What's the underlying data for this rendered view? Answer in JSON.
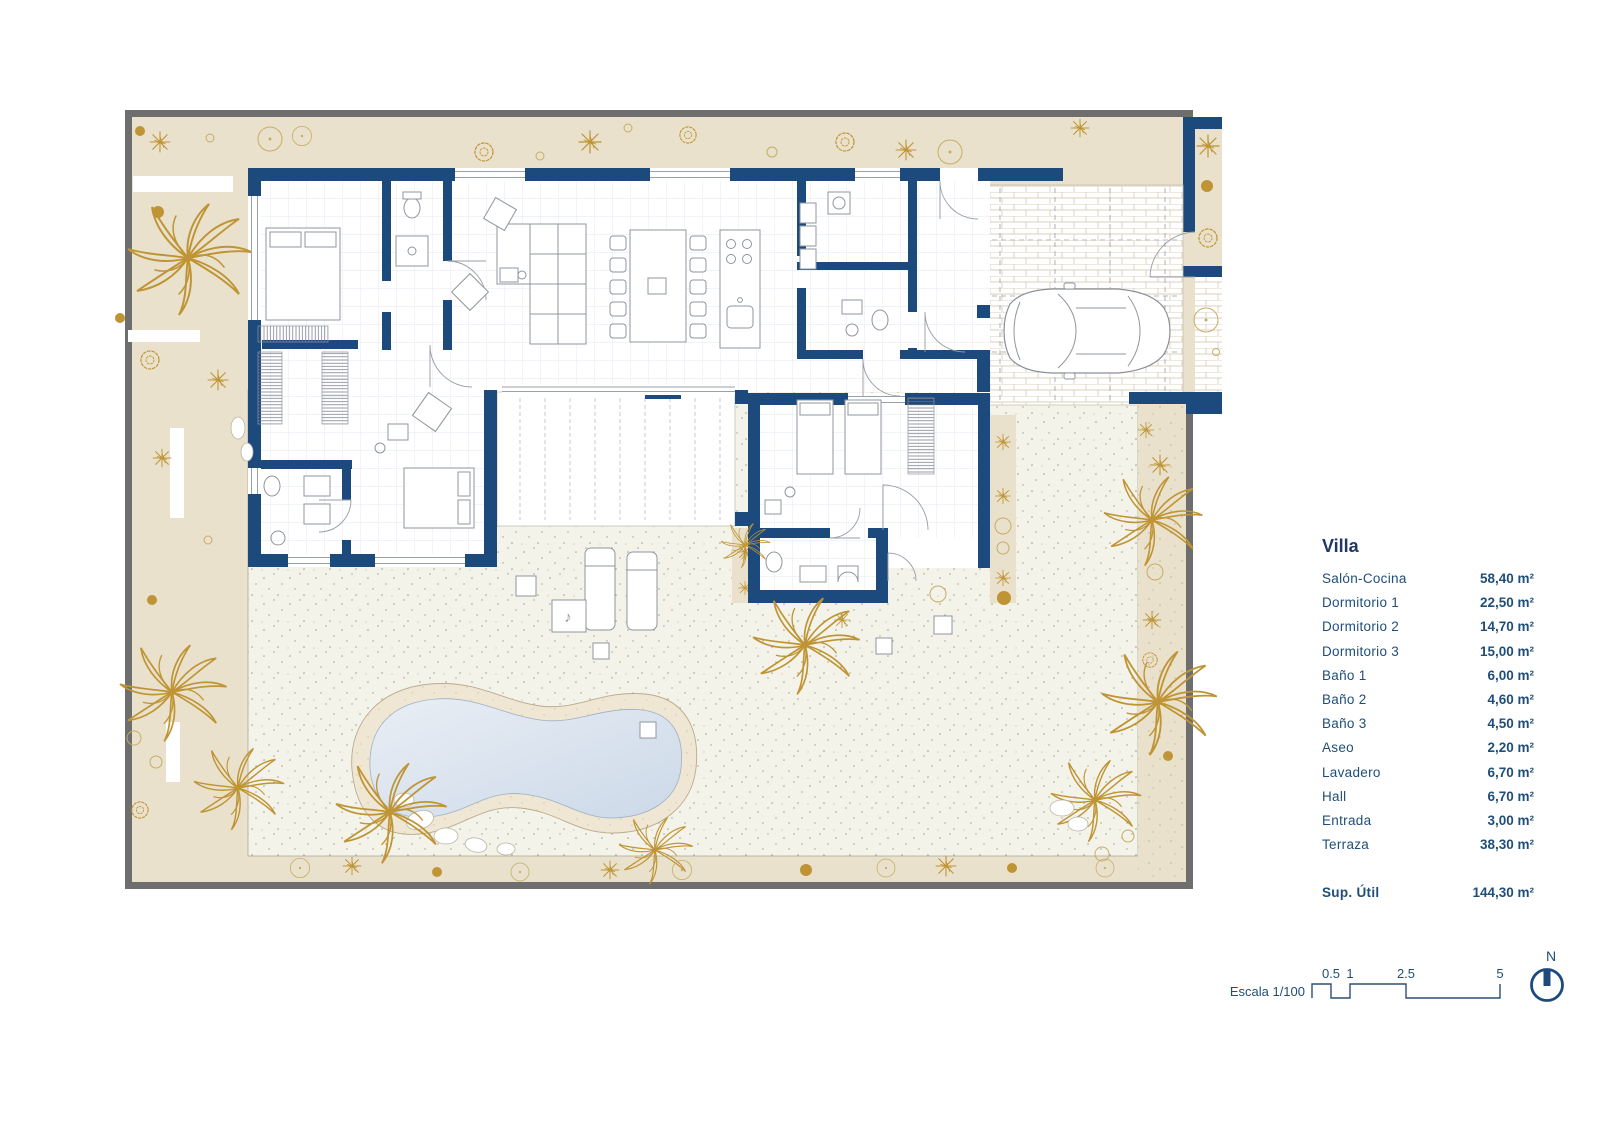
{
  "page": {
    "background": "#ffffff"
  },
  "colors": {
    "wall_navy": "#1d4a7d",
    "garden_beige": "#e9e1cb",
    "frame_gray": "#6e6e6e",
    "plant_gold": "#bf9434",
    "terrace_cream": "#f4f3ea",
    "pool_water": "#d8e2ee",
    "pool_sand": "#efe7d3",
    "line_gray": "#8f959e",
    "text_navy": "#1f4e79",
    "grid_blue": "#e2e7ef",
    "brick_tan": "#d9d2bf"
  },
  "legend": {
    "title": "Villa",
    "rooms": [
      {
        "name": "Salón-Cocina",
        "area": "58,40 m²"
      },
      {
        "name": "Dormitorio 1",
        "area": "22,50 m²"
      },
      {
        "name": "Dormitorio 2",
        "area": "14,70 m²"
      },
      {
        "name": "Dormitorio 3",
        "area": "15,00 m²"
      },
      {
        "name": "Baño 1",
        "area": "6,00 m²"
      },
      {
        "name": "Baño 2",
        "area": "4,60 m²"
      },
      {
        "name": "Baño 3",
        "area": "4,50 m²"
      },
      {
        "name": "Aseo",
        "area": "2,20 m²"
      },
      {
        "name": "Lavadero",
        "area": "6,70 m²"
      },
      {
        "name": "Hall",
        "area": "6,70 m²"
      },
      {
        "name": "Entrada",
        "area": "3,00 m²"
      },
      {
        "name": "Terraza",
        "area": "38,30 m²"
      }
    ],
    "total": {
      "name": "Sup. Útil",
      "area": "144,30 m²"
    }
  },
  "scale_bar": {
    "label": "Escala 1/100",
    "ticks": [
      "0.5",
      "1",
      "2.5",
      "5"
    ]
  },
  "compass": {
    "label": "N"
  }
}
